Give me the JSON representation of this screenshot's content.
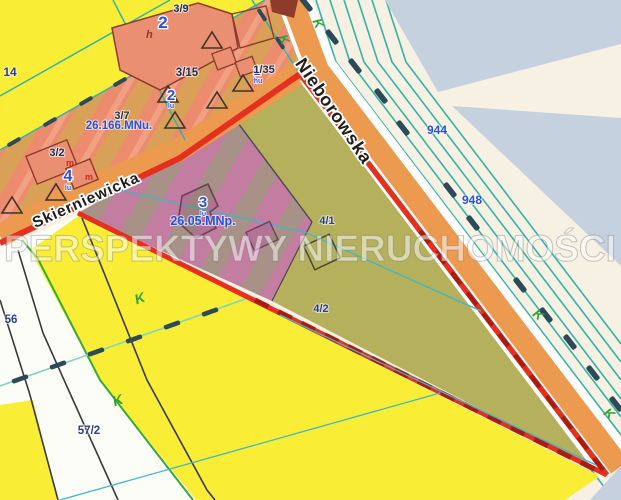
{
  "watermark_text": "PERSPEKTYWY NIERUCHOMOŚCI",
  "streets": {
    "skierniewicka": "Skierniewicka",
    "nieborowska": "Nieborowska"
  },
  "zone_labels": {
    "mnu": "26.166.MNu.",
    "mnp": "26.05.MNp."
  },
  "parcel_labels": {
    "p3_9": "3/9",
    "p3_15": "3/15",
    "p3_7": "3/7",
    "p3_2": "3/2",
    "p1_35": "1/35",
    "p4_1": "4/1",
    "p4_2": "4/2",
    "p57_2": "57/2",
    "p56": "56",
    "p14": "14",
    "p944": "944",
    "p948": "948"
  },
  "marker_badges": {
    "badge_2_top": "2",
    "badge_2_mid": "2",
    "badge_4": "4",
    "badge_3": "3",
    "badge_1": "1",
    "sub_lu": "lu",
    "sub_hu": "hu",
    "letter_h": "h",
    "letter_m": "m",
    "letter_k": "K"
  },
  "colors": {
    "highlight_red": "#e6301f",
    "highlight_dash_red": "#a81c12",
    "road_orange": "#eb9a50",
    "zone_yellow": "#f9ee35",
    "zone_residential_stripe_a": "#ec8b6e",
    "zone_residential_stripe_b": "#d9a058",
    "zone_mnp_stripe_a": "#c27da1",
    "zone_mnp_stripe_b": "#a89186",
    "parcel_olive": "#b5b05c",
    "water_blue_gray": "#c5d1de",
    "survey_teal": "#35b3a8",
    "label_blue": "#2b50e0"
  }
}
